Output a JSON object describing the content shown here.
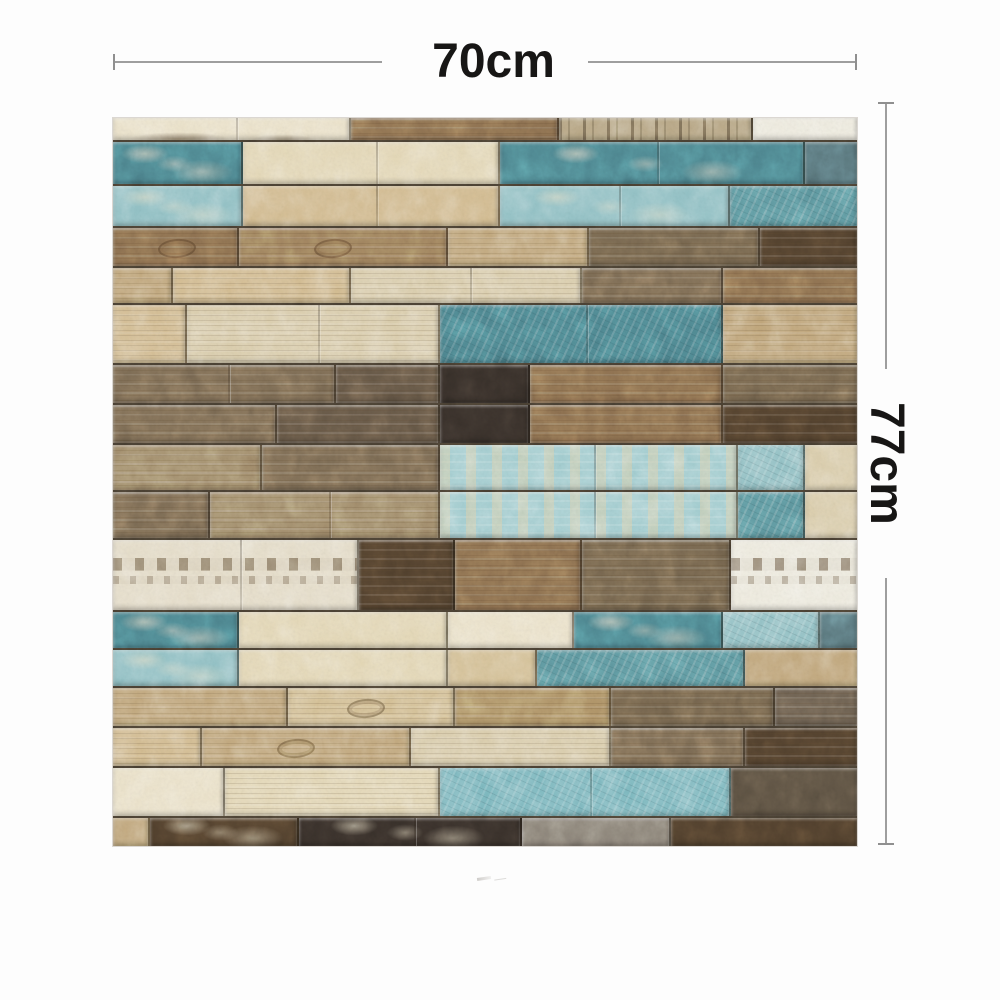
{
  "dimensions": {
    "width_label": "70cm",
    "height_label": "77cm"
  },
  "annotation": {
    "line_color": "#9e9e9e",
    "cap_color": "#8f8f8f",
    "text_color": "#171615"
  },
  "panel": {
    "seam_color": "rgba(30,23,16,0.78)",
    "palette": {
      "white": "#efece0",
      "creamPale": "#ece3cb",
      "cream": "#e5d9b8",
      "sand": "#d6c298",
      "beige": "#d4bd92",
      "pale": "#dccfae",
      "tan": "#c2a87d",
      "khaki": "#b09468",
      "taupeLight": "#a38e6d",
      "taupe": "#7c6b54",
      "dkTaupe": "#655746",
      "brown": "#8c6f4f",
      "brownLight": "#9f815d",
      "grayBrown": "#75654e",
      "dkBrown": "#51402d",
      "dkGrayBrown": "#5c5142",
      "dkGray": "#6a5e4f",
      "black": "#38302a",
      "gray": "#8b8378",
      "streakBase": "#b9a886",
      "dappleBase": "#e6deca",
      "teal": "#5e98a0",
      "tealDark": "#4d858f",
      "tealLight": "#93c2c6",
      "tealGhost": "#a5cfd2",
      "tealBright": "#7fbac1",
      "slate": "#5a777d"
    },
    "rows": [
      {
        "h": 24,
        "planks": [
          {
            "w": 0.32,
            "c": "creamPale",
            "t": "smudge"
          },
          {
            "w": 0.28,
            "c": "brown",
            "t": "wood"
          },
          {
            "w": 0.26,
            "c": "streakBase",
            "t": "streaks"
          },
          {
            "w": 0.14,
            "c": "white"
          }
        ]
      },
      {
        "h": 44,
        "planks": [
          {
            "w": 0.175,
            "c": "tealDark",
            "t": "mottle"
          },
          {
            "w": 0.345,
            "c": "cream"
          },
          {
            "w": 0.41,
            "c": "tealDark",
            "t": "mottle"
          },
          {
            "w": 0.07,
            "c": "slate"
          }
        ]
      },
      {
        "h": 42,
        "planks": [
          {
            "w": 0.175,
            "c": "tealLight",
            "t": "mottle"
          },
          {
            "w": 0.345,
            "c": "beige"
          },
          {
            "w": 0.31,
            "c": "tealLight",
            "t": "mottle"
          },
          {
            "w": 0.17,
            "c": "teal",
            "t": "crackle"
          }
        ]
      },
      {
        "h": 40,
        "planks": [
          {
            "w": 0.17,
            "c": "brown",
            "t": "wood knot"
          },
          {
            "w": 0.28,
            "c": "brownLight",
            "t": "wood knot"
          },
          {
            "w": 0.19,
            "c": "tan",
            "t": "wood"
          },
          {
            "w": 0.23,
            "c": "grayBrown",
            "t": "wood"
          },
          {
            "w": 0.13,
            "c": "dkBrown",
            "t": "wood"
          }
        ]
      },
      {
        "h": 37,
        "planks": [
          {
            "w": 0.08,
            "c": "tan",
            "t": "wood"
          },
          {
            "w": 0.24,
            "c": "beige",
            "t": "wood"
          },
          {
            "w": 0.31,
            "c": "pale",
            "t": "wood"
          },
          {
            "w": 0.19,
            "c": "taupe",
            "t": "wood"
          },
          {
            "w": 0.18,
            "c": "brown",
            "t": "wood"
          }
        ]
      },
      {
        "h": 60,
        "planks": [
          {
            "w": 0.1,
            "c": "beige",
            "t": "wood"
          },
          {
            "w": 0.34,
            "c": "pale",
            "t": "wood"
          },
          {
            "w": 0.38,
            "c": "tealDark",
            "t": "crackle"
          },
          {
            "w": 0.18,
            "c": "tan",
            "t": "wood"
          }
        ]
      },
      {
        "h": 40,
        "planks": [
          {
            "w": 0.3,
            "c": "taupe",
            "t": "wood"
          },
          {
            "w": 0.14,
            "c": "dkTaupe",
            "t": "wood"
          },
          {
            "w": 0.12,
            "c": "black"
          },
          {
            "w": 0.26,
            "c": "brown",
            "t": "wood"
          },
          {
            "w": 0.18,
            "c": "grayBrown",
            "t": "wood"
          }
        ]
      },
      {
        "h": 40,
        "planks": [
          {
            "w": 0.22,
            "c": "taupe",
            "t": "wood"
          },
          {
            "w": 0.22,
            "c": "dkTaupe",
            "t": "wood"
          },
          {
            "w": 0.12,
            "c": "black"
          },
          {
            "w": 0.26,
            "c": "brown",
            "t": "wood"
          },
          {
            "w": 0.18,
            "c": "dkBrown",
            "t": "wood"
          }
        ]
      },
      {
        "h": 47,
        "planks": [
          {
            "w": 0.2,
            "c": "taupeLight",
            "t": "wood"
          },
          {
            "w": 0.24,
            "c": "taupe",
            "t": "wood"
          },
          {
            "w": 0.4,
            "c": "tealGhost",
            "t": "ghost"
          },
          {
            "w": 0.09,
            "c": "tealLight",
            "t": "crackle"
          },
          {
            "w": 0.07,
            "c": "pale"
          }
        ]
      },
      {
        "h": 48,
        "planks": [
          {
            "w": 0.13,
            "c": "taupe",
            "t": "wood"
          },
          {
            "w": 0.31,
            "c": "taupeLight",
            "t": "wood"
          },
          {
            "w": 0.4,
            "c": "tealGhost",
            "t": "ghost"
          },
          {
            "w": 0.09,
            "c": "teal",
            "t": "crackle"
          },
          {
            "w": 0.07,
            "c": "pale"
          }
        ]
      },
      {
        "h": 72,
        "planks": [
          {
            "w": 0.33,
            "c": "dappleBase",
            "t": "dapple"
          },
          {
            "w": 0.13,
            "c": "dkBrown",
            "t": "wood"
          },
          {
            "w": 0.17,
            "c": "brown",
            "t": "wood"
          },
          {
            "w": 0.2,
            "c": "grayBrown",
            "t": "wood"
          },
          {
            "w": 0.17,
            "c": "white",
            "t": "dapple"
          }
        ]
      },
      {
        "h": 38,
        "planks": [
          {
            "w": 0.17,
            "c": "tealDark",
            "t": "mottle"
          },
          {
            "w": 0.28,
            "c": "cream"
          },
          {
            "w": 0.17,
            "c": "creamPale"
          },
          {
            "w": 0.2,
            "c": "tealDark",
            "t": "mottle"
          },
          {
            "w": 0.13,
            "c": "tealLight",
            "t": "crackle"
          },
          {
            "w": 0.05,
            "c": "slate"
          }
        ]
      },
      {
        "h": 38,
        "planks": [
          {
            "w": 0.17,
            "c": "tealLight",
            "t": "mottle"
          },
          {
            "w": 0.28,
            "c": "cream"
          },
          {
            "w": 0.12,
            "c": "sand"
          },
          {
            "w": 0.28,
            "c": "teal",
            "t": "crackle"
          },
          {
            "w": 0.15,
            "c": "tan"
          }
        ]
      },
      {
        "h": 40,
        "planks": [
          {
            "w": 0.235,
            "c": "tan",
            "t": "wood"
          },
          {
            "w": 0.225,
            "c": "sand",
            "t": "wood knot"
          },
          {
            "w": 0.21,
            "c": "khaki",
            "t": "wood"
          },
          {
            "w": 0.22,
            "c": "grayBrown",
            "t": "wood"
          },
          {
            "w": 0.11,
            "c": "dkGray",
            "t": "wood"
          }
        ]
      },
      {
        "h": 40,
        "planks": [
          {
            "w": 0.12,
            "c": "beige",
            "t": "wood"
          },
          {
            "w": 0.28,
            "c": "tan",
            "t": "wood knot"
          },
          {
            "w": 0.27,
            "c": "pale",
            "t": "wood"
          },
          {
            "w": 0.18,
            "c": "taupe",
            "t": "wood"
          },
          {
            "w": 0.15,
            "c": "dkBrown",
            "t": "wood"
          }
        ]
      },
      {
        "h": 50,
        "planks": [
          {
            "w": 0.15,
            "c": "creamPale"
          },
          {
            "w": 0.29,
            "c": "cream",
            "t": "wood"
          },
          {
            "w": 0.39,
            "c": "tealBright",
            "t": "crackle"
          },
          {
            "w": 0.17,
            "c": "dkGrayBrown"
          }
        ]
      },
      {
        "h": 28,
        "planks": [
          {
            "w": 0.05,
            "c": "tan"
          },
          {
            "w": 0.2,
            "c": "dkBrown",
            "t": "mottle"
          },
          {
            "w": 0.3,
            "c": "black",
            "t": "mottle"
          },
          {
            "w": 0.2,
            "c": "gray"
          },
          {
            "w": 0.25,
            "c": "dkBrown"
          }
        ]
      }
    ]
  }
}
